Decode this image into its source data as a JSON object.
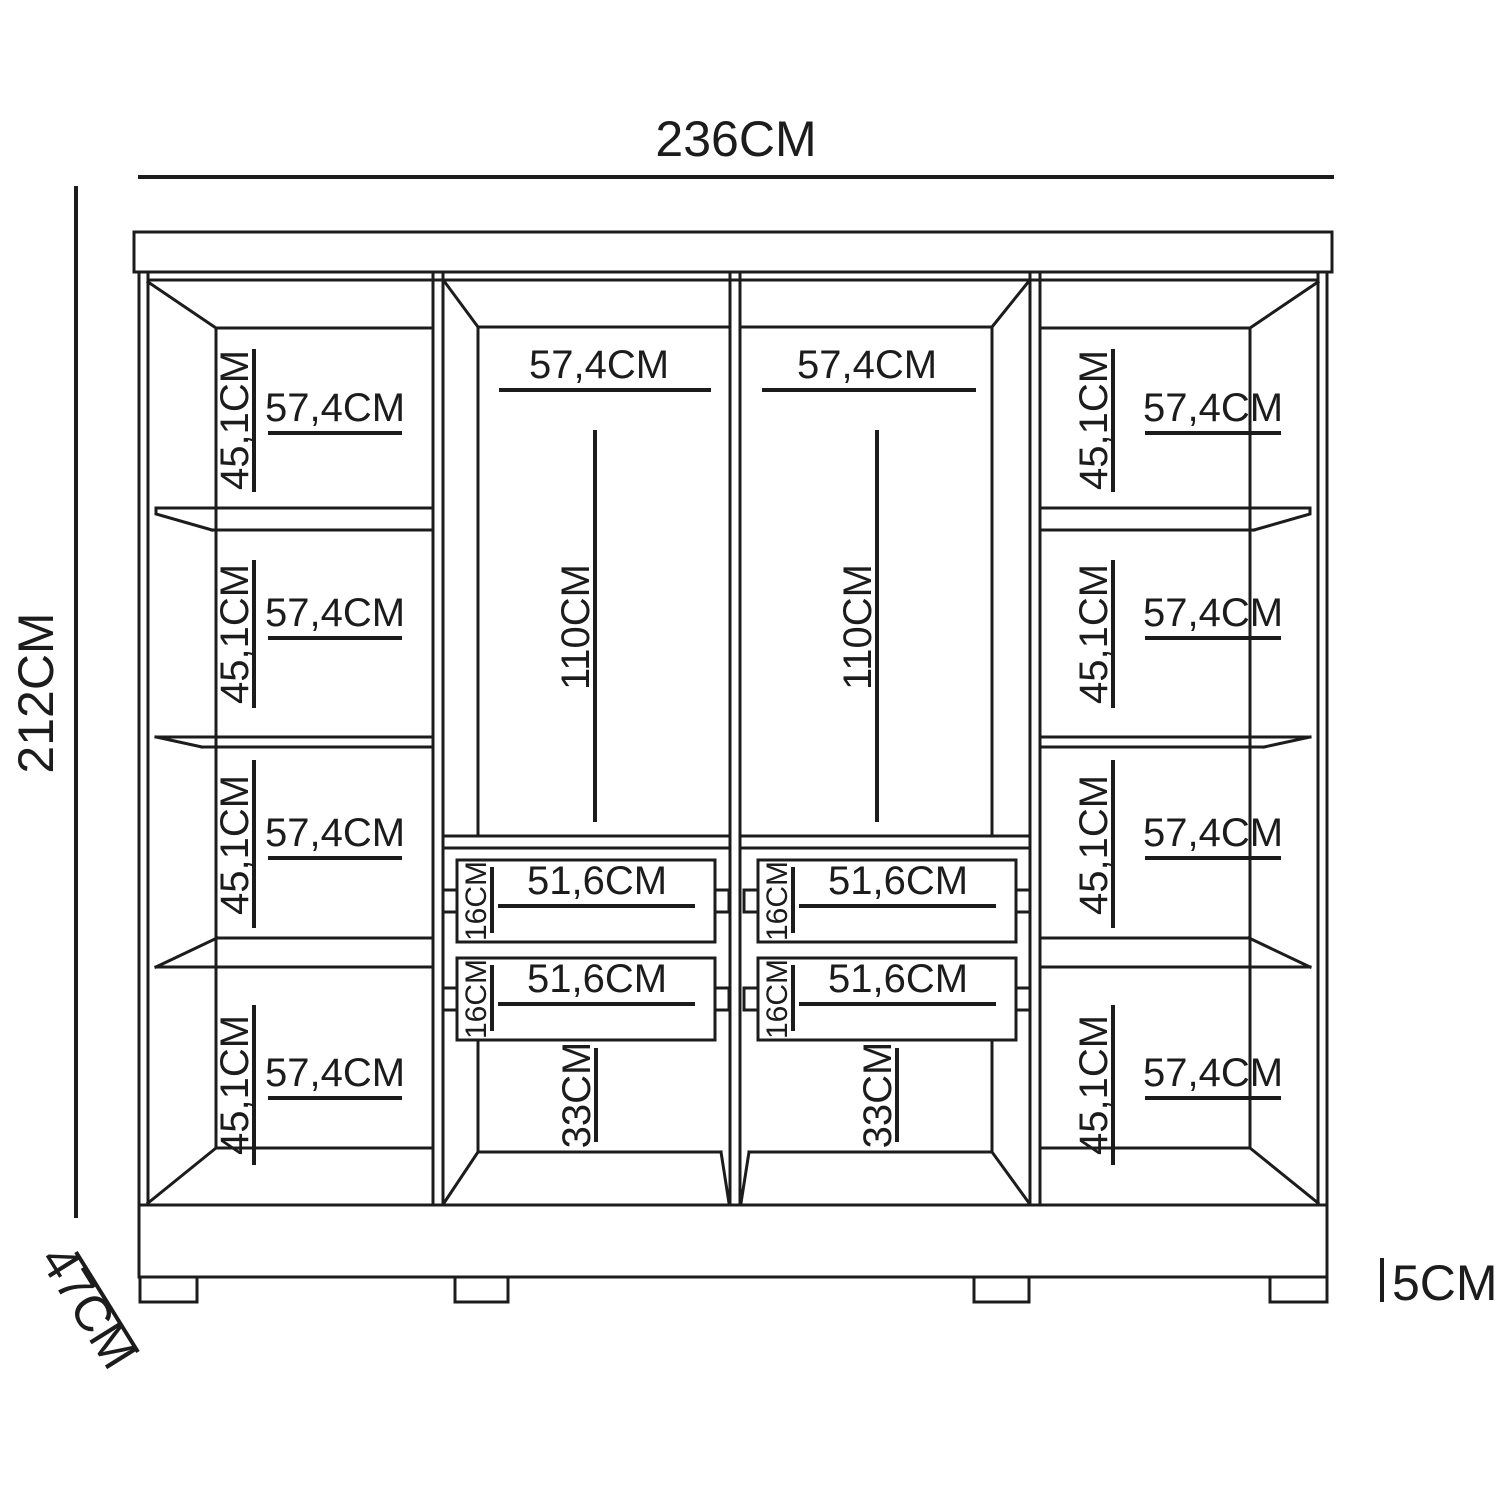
{
  "figure": {
    "type": "furniture-dimension-diagram",
    "subject": "wardrobe front elevation technical drawing"
  },
  "dims": {
    "width_total": "236CM",
    "height_total": "212CM",
    "depth_total": "47CM",
    "feet_height": "5CM",
    "cubby_width": "57,4CM",
    "cubby_height": "45,1CM",
    "hanging_width": "57,4CM",
    "hanging_height": "110CM",
    "drawer_width": "51,6CM",
    "drawer_height": "16CM",
    "base_opening_height": "33CM"
  },
  "counts": {
    "side_cubbies": 8,
    "shelves_per_side_column": 3,
    "hanging_sections": 2,
    "drawers": 4,
    "feet": 4
  },
  "colors": {
    "line": "#1c1c1c",
    "background": "#ffffff"
  }
}
